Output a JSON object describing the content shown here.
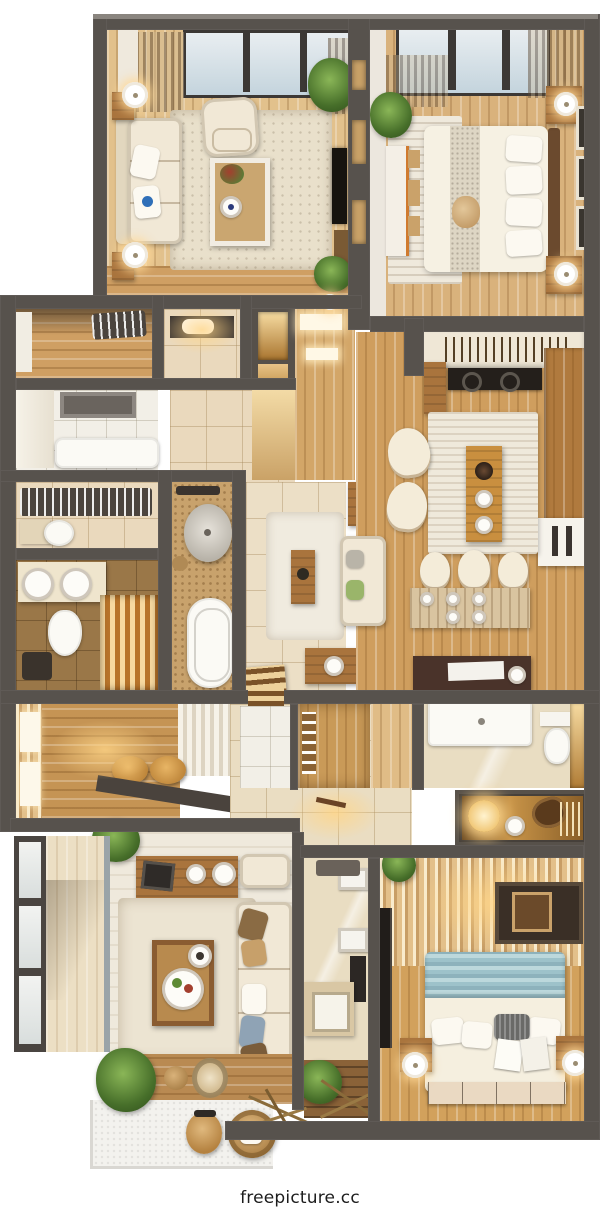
{
  "watermark": "freepicture.cc",
  "scene": {
    "type": "top-down 3D apartment floor-plan render",
    "rooms": [
      {
        "id": "living-room",
        "label": "Living room"
      },
      {
        "id": "master-bedroom",
        "label": "Master bedroom"
      },
      {
        "id": "entry-hall",
        "label": "Entry hall"
      },
      {
        "id": "powder-room",
        "label": "Powder room"
      },
      {
        "id": "laundry-room",
        "label": "Laundry room"
      },
      {
        "id": "walk-in-closet",
        "label": "Walk-in closet"
      },
      {
        "id": "guest-bathroom",
        "label": "Guest bathroom"
      },
      {
        "id": "master-bathroom",
        "label": "Master bathroom"
      },
      {
        "id": "central-hallway",
        "label": "Central hallway"
      },
      {
        "id": "kitchen",
        "label": "Kitchen"
      },
      {
        "id": "dining-room",
        "label": "Dining room"
      },
      {
        "id": "second-bathroom",
        "label": "Second bathroom"
      },
      {
        "id": "bar-niche",
        "label": "Lit bar niche"
      },
      {
        "id": "second-bedroom",
        "label": "Second bedroom"
      },
      {
        "id": "family-room",
        "label": "Family room"
      },
      {
        "id": "balcony",
        "label": "Balcony"
      },
      {
        "id": "patio-terrace",
        "label": "Patio terrace"
      }
    ],
    "palette": {
      "wall": "#57524d",
      "wood_light": "#e2c18c",
      "wood_mid": "#cf9f63",
      "wood_dark": "#8a6238",
      "tile_beige": "#ead9bd",
      "tile_white": "#f2efe7",
      "mosaic_tan": "#c8a26c",
      "cream_fabric": "#f1e8d6",
      "glass_blue": "#cfdde6",
      "plant_green": "#4e7a30",
      "teal_blanket": "#a3c6cd",
      "warm_glow": "#ffd793",
      "watermark_text": "#1c1c1c"
    }
  }
}
